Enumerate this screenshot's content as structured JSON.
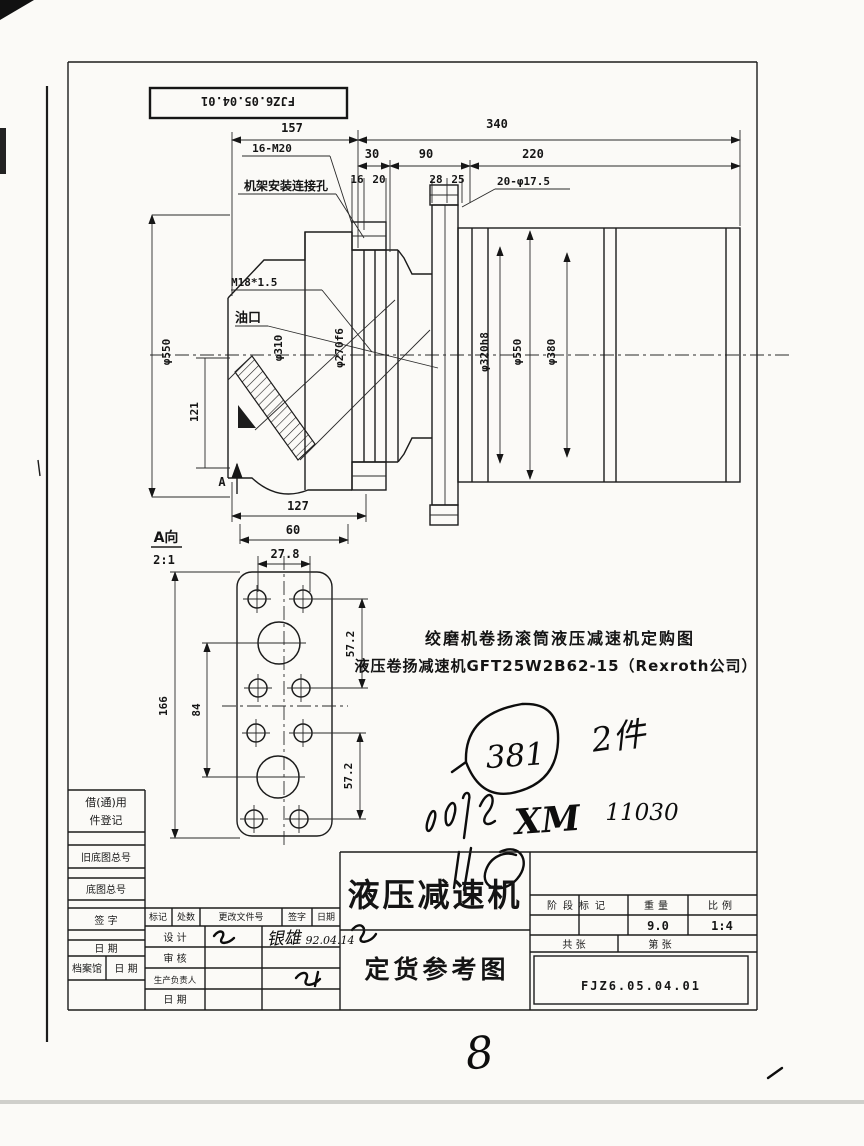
{
  "meta": {
    "ink_color": "#1c1c1c",
    "paper_color": "#fbfaf7"
  },
  "stamp": {
    "number": "FJZ6.05.04.01"
  },
  "main_view": {
    "d157": "157",
    "d340": "340",
    "d30": "30",
    "d90": "90",
    "d220": "220",
    "d16": "16",
    "d20": "20",
    "d28": "28",
    "d25": "25",
    "holes_label": "20-φ17.5",
    "bolt_label": "16-M20",
    "frame_label": "机架安装连接孔",
    "thread_label": "M18*1.5",
    "oil_label": "油口",
    "dia_left": "φ550",
    "dia_hub": "φ310",
    "dia_fit": "φ270f6",
    "dia_drum_fit": "φ320h8",
    "dia_drum": "φ550",
    "dia_end": "φ380",
    "d121": "121",
    "d127": "127",
    "d60": "60",
    "view_letter": "A"
  },
  "detail_view": {
    "title": "A向",
    "scale": "2:1",
    "d27_8": "27.8",
    "d166": "166",
    "d84": "84",
    "d57_2_top": "57.2",
    "d57_2_bottom": "57.2"
  },
  "notes": {
    "line1": "绞磨机卷扬滚筒液压减速机定购图",
    "line2": "液压卷扬减速机GFT25W2B62-15（Rexroth公司）"
  },
  "handwritten": {
    "circled_number": "381",
    "quantity": "2件",
    "code": "XM",
    "code_number": "11030",
    "signature": "银雄",
    "sign_date": "92.04.14",
    "sheet_number": "8"
  },
  "title_block": {
    "left_col": {
      "borrow_line1": "借(通)用",
      "borrow_line2": "件登记",
      "old_base_no": "旧底图总号",
      "base_no": "底图总号",
      "sign": "签 字",
      "date": "日 期",
      "archive": "档案馆",
      "archive_date": "日 期"
    },
    "change_header": {
      "mark": "标记",
      "count": "处数",
      "file_no": "更改文件号",
      "sign": "签字",
      "date": "日期"
    },
    "role_rows": {
      "design": "设 计",
      "audit": "审 核",
      "production": "生产负责人",
      "date": "日 期"
    },
    "product_name": "液压减速机",
    "drawing_type": "定货参考图",
    "stage_label": "阶段标记",
    "weight_label": "重量",
    "scale_label": "比例",
    "weight_value": "9.0",
    "scale_value": "1:4",
    "sheets_total": "共  张",
    "sheet_no": "第  张",
    "drawing_number": "FJZ6.05.04.01"
  }
}
